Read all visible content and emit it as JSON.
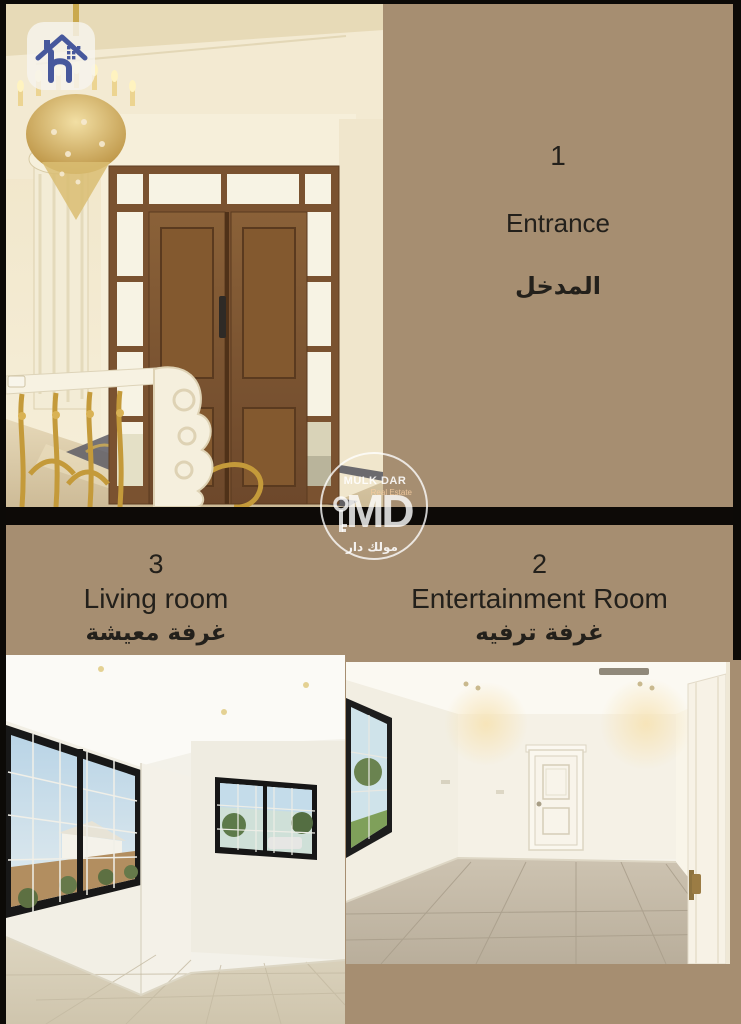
{
  "watermark": {
    "brand": "MULK DAR",
    "tagline": "Real Estate",
    "monogram": "MD",
    "brand_ar": "مولك دار"
  },
  "rooms": {
    "entrance": {
      "number": "1",
      "name_en": "Entrance",
      "name_ar": "المدخل"
    },
    "entertainment": {
      "number": "2",
      "name_en": "Entertainment Room",
      "name_ar": "غرفة ترفيه"
    },
    "living": {
      "number": "3",
      "name_en": "Living room",
      "name_ar": "غرفة معيشة"
    }
  },
  "icons": {
    "logo": "house-logo-icon",
    "watermark_key": "key-icon"
  },
  "colors": {
    "background_tan": "#a68e71",
    "divider_black": "#0d0a07",
    "label_text": "#23201b",
    "logo_house_blue": "#47589c",
    "watermark_white": "#ffffff",
    "gold_chandelier": "#c9a23f",
    "door_wood_brown": "#7a5230"
  }
}
